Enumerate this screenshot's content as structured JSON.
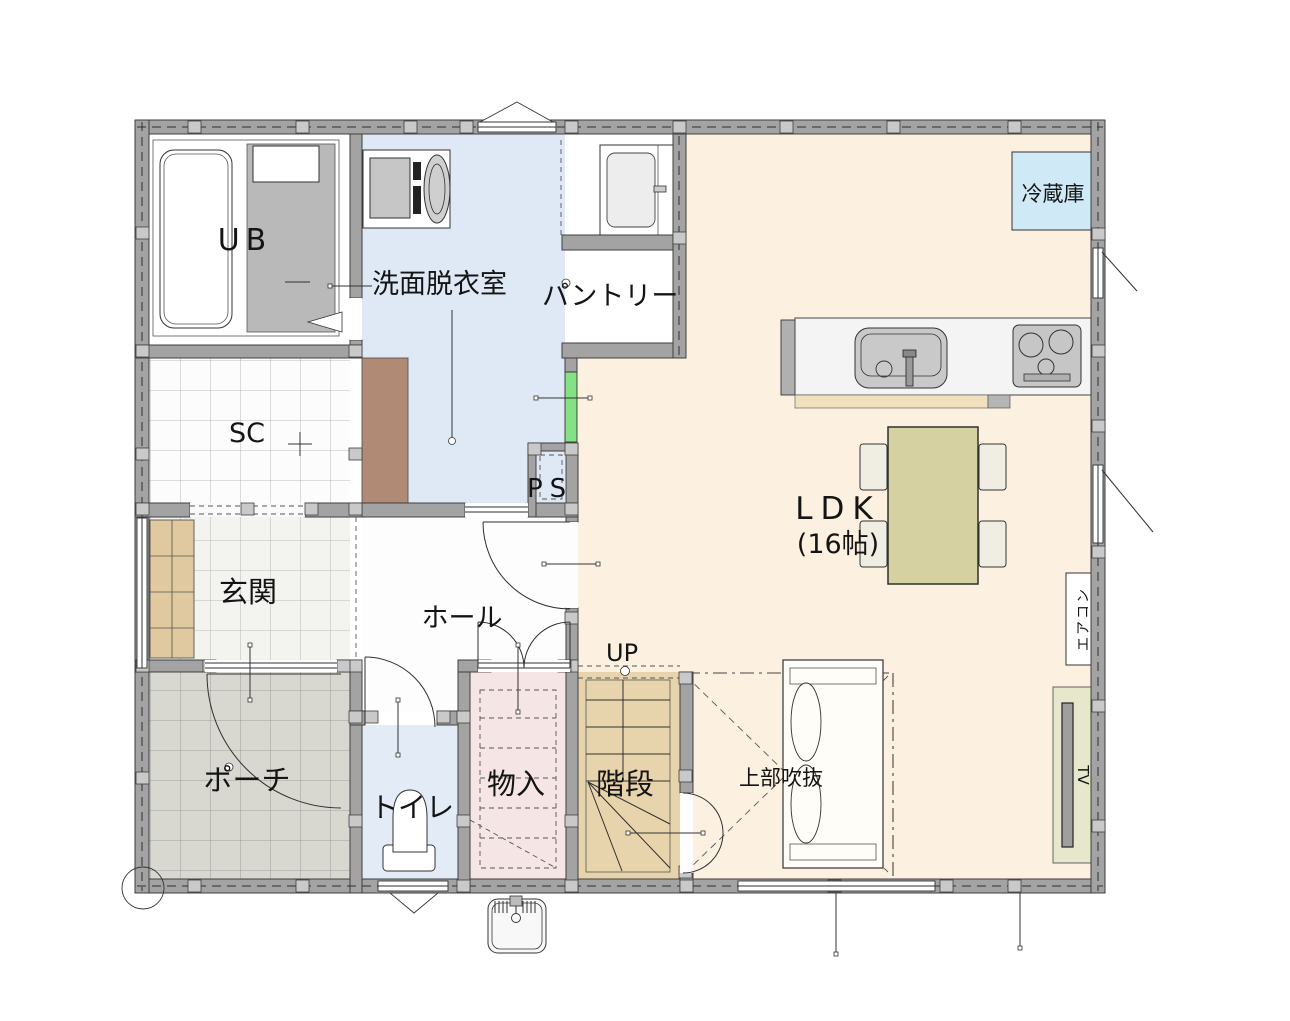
{
  "plan": {
    "rooms": {
      "ub": "UB",
      "washroom": "洗面脱衣室",
      "pantry": "パントリー",
      "sc": "SC",
      "ps": "PS",
      "genkan": "玄関",
      "hall": "ホール",
      "porch": "ポーチ",
      "toilet": "トイレ",
      "storage": "物入",
      "stairs": "階段",
      "stairs_up": "UP",
      "ldk": "LDK",
      "ldk_size": "(16帖)",
      "void_above": "上部吹抜"
    },
    "labels": {
      "refrigerator": "冷蔵庫",
      "aircon": "エアコン",
      "tv": "TV"
    },
    "colors": {
      "wall": "#a3a3a3",
      "pillar": "#c9c9c9",
      "ldk_floor": "#fcf1e0",
      "washroom_floor": "#dfe8f5",
      "toilet_floor": "#e3ebf7",
      "storage_floor": "#f6e5e5",
      "stairs_floor": "#e8d4ac",
      "porch_floor": "#d8d8d0",
      "genkan_floor": "#f3f3f0",
      "sc_floor": "#fcfcfc",
      "ps_duct": "#84e184",
      "refrigerator_fill": "#cfe9f7",
      "table_fill": "#d6d1a1",
      "chair_fill": "#f0ede3",
      "tv_board_fill": "#e7e7cb",
      "shoe_cabinet_fill": "#e0c99e",
      "closet_brown": "#b08a74",
      "bath_floor_gray": "#b9b9b9"
    }
  }
}
